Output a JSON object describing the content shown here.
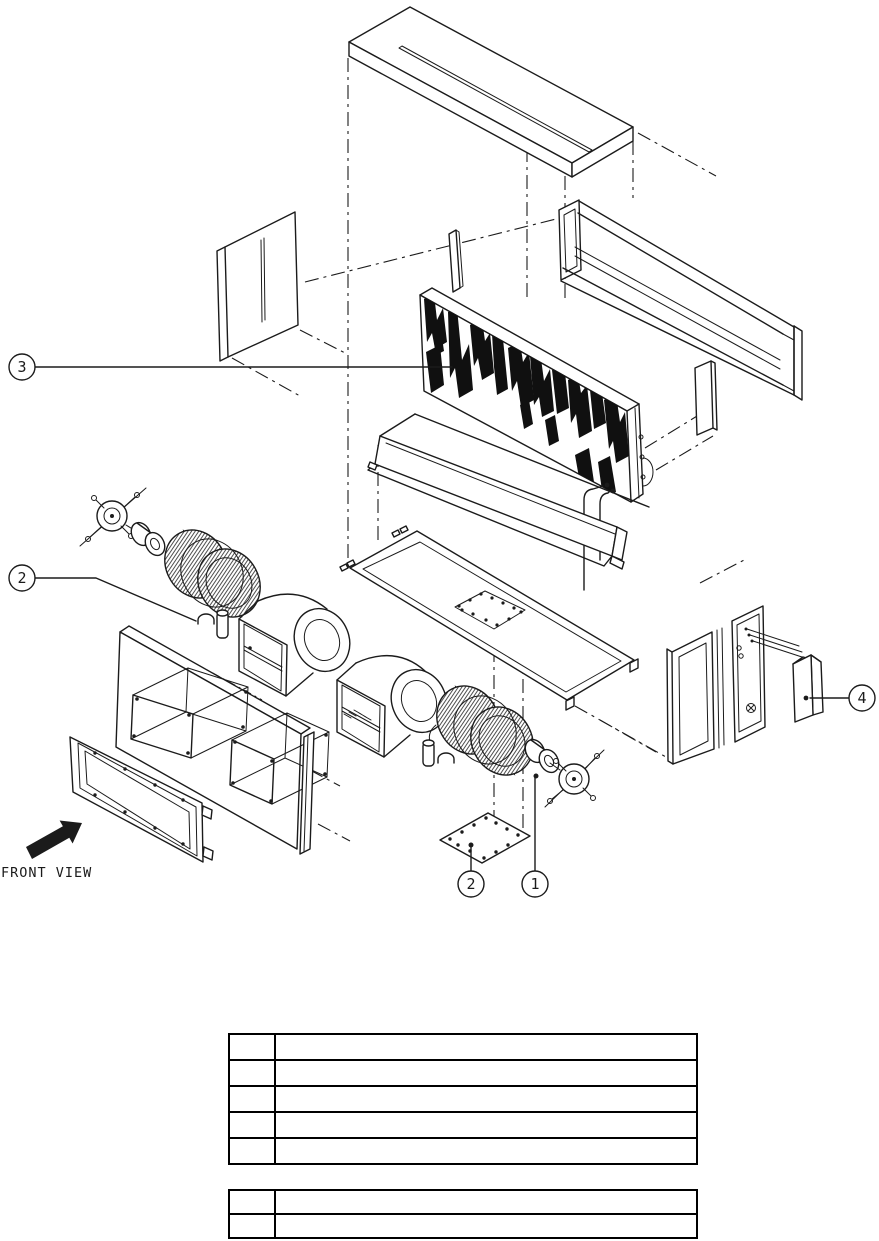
{
  "page": {
    "background_color": "#ffffff",
    "line_color": "#1b1b1b"
  },
  "diagram": {
    "type": "exploded-parts-diagram",
    "subject": "air-handling-unit",
    "front_view_label": "FRONT VIEW",
    "callouts": [
      {
        "ref": "3",
        "position": "left-upper",
        "points_to": "heat-exchanger-coil"
      },
      {
        "ref": "2",
        "position": "left-middle",
        "points_to": "blower-clamp-area"
      },
      {
        "ref": "2",
        "position": "bottom-left",
        "points_to": "mounting-plate"
      },
      {
        "ref": "1",
        "position": "bottom-right",
        "points_to": "fan-motor"
      },
      {
        "ref": "4",
        "position": "right",
        "points_to": "electrical-box"
      }
    ]
  },
  "tables": {
    "upper": {
      "rows": [
        [
          "",
          ""
        ],
        [
          "",
          ""
        ],
        [
          "",
          ""
        ],
        [
          "",
          ""
        ],
        [
          "",
          ""
        ]
      ]
    },
    "lower": {
      "rows": [
        [
          "",
          ""
        ],
        [
          "",
          ""
        ]
      ]
    }
  }
}
